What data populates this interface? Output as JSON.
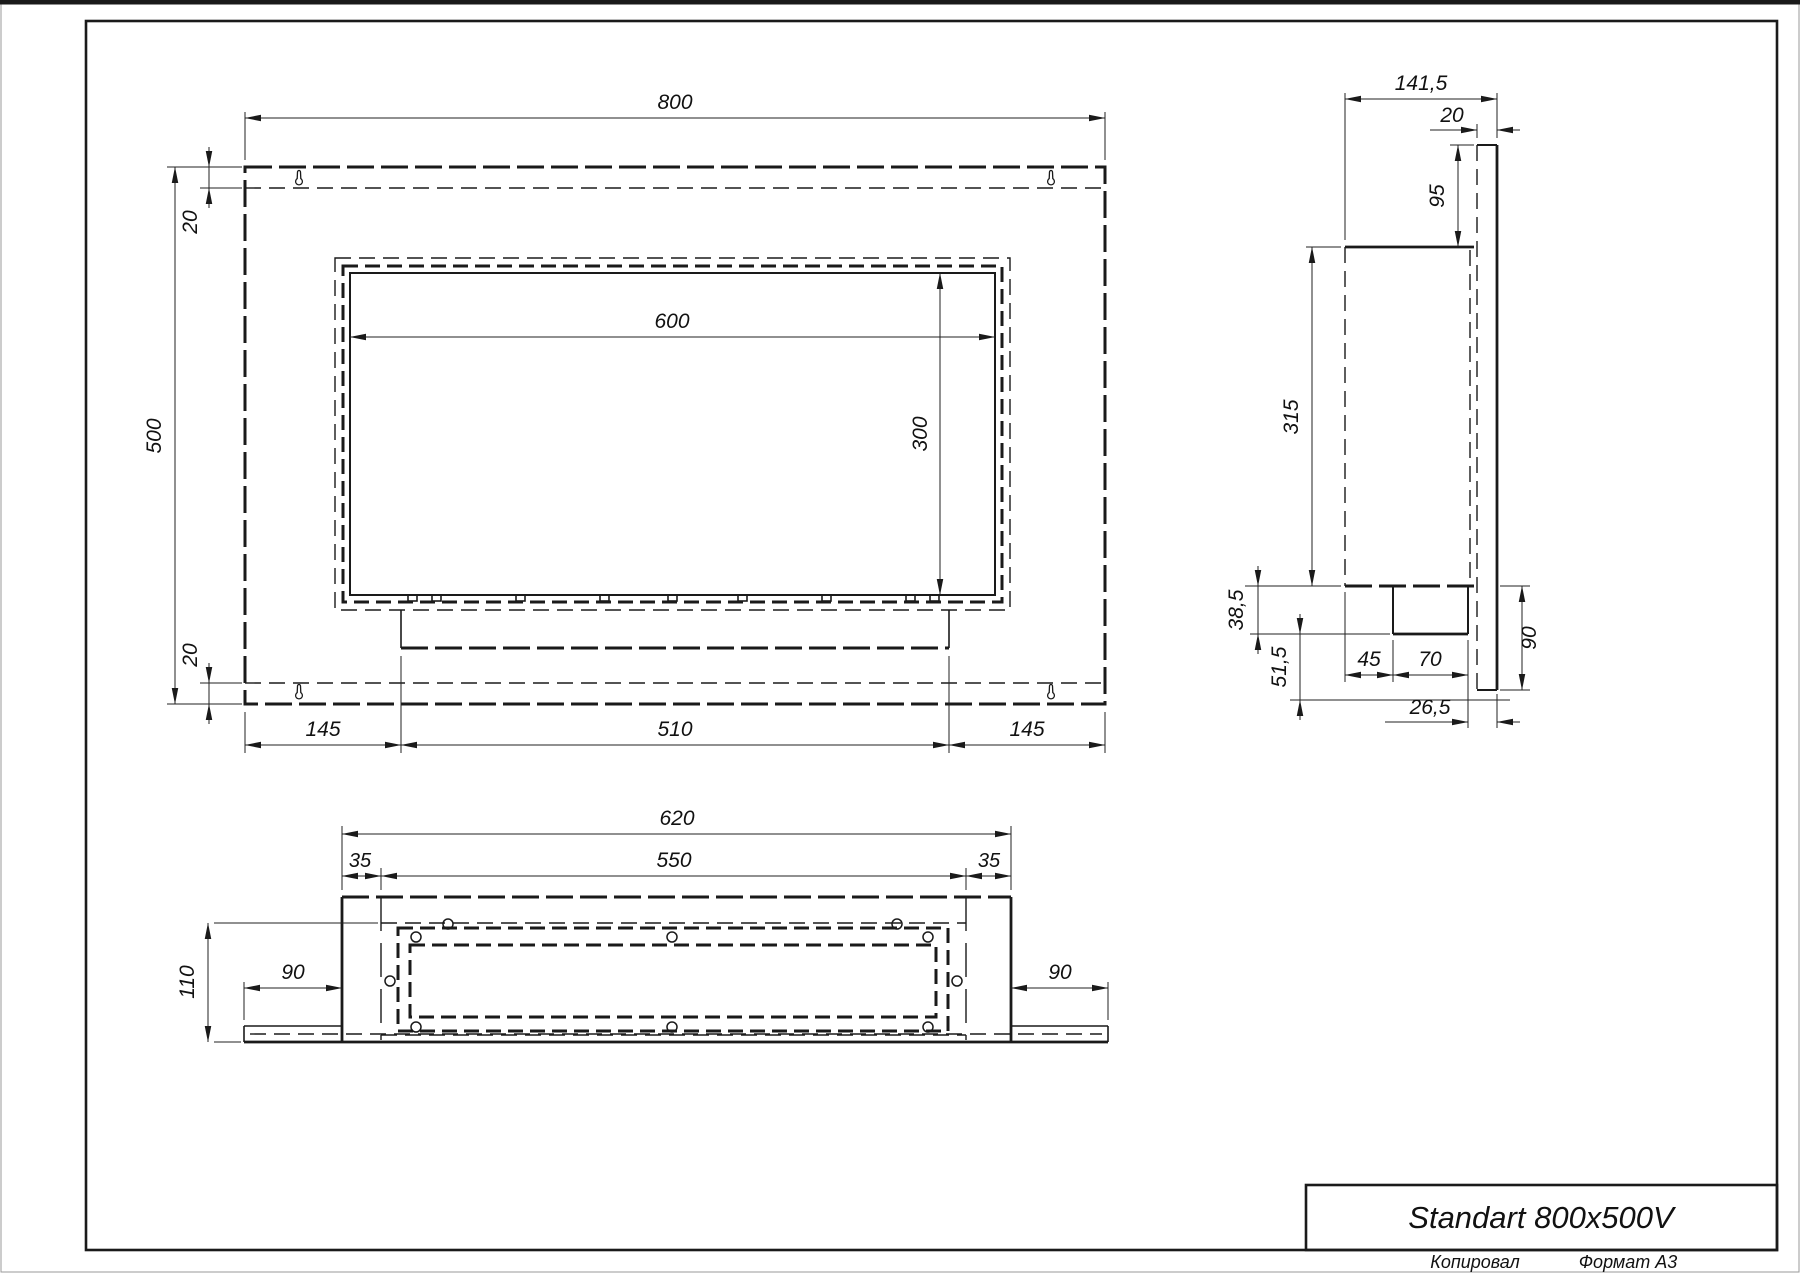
{
  "title_block": {
    "title": "Standart 800x500V",
    "copied_label": "Копировал",
    "format_label": "Формат А3"
  },
  "views": {
    "front": {
      "dims": {
        "width": "800",
        "height": "500",
        "flange_top": "20",
        "flange_bottom": "20",
        "opening_width": "600",
        "opening_height": "300",
        "bottom_left": "145",
        "bottom_center": "510",
        "bottom_right": "145"
      }
    },
    "side": {
      "dims": {
        "depth": "141,5",
        "back_panel_thickness": "20",
        "top_offset": "95",
        "body_height": "315",
        "plate_height": "38,5",
        "lower_offset": "51,5",
        "box_offset": "45",
        "box_width": "70",
        "bottom_height": "90",
        "back_gap": "26,5"
      }
    },
    "bottom": {
      "dims": {
        "width": "620",
        "opening_width": "550",
        "margin_left": "35",
        "margin_right": "35",
        "depth": "110",
        "wing_left": "90",
        "wing_right": "90"
      }
    }
  },
  "colors": {
    "line": "#1a1a1a",
    "page_edge": "#9a9a9a",
    "background": "#ffffff"
  }
}
